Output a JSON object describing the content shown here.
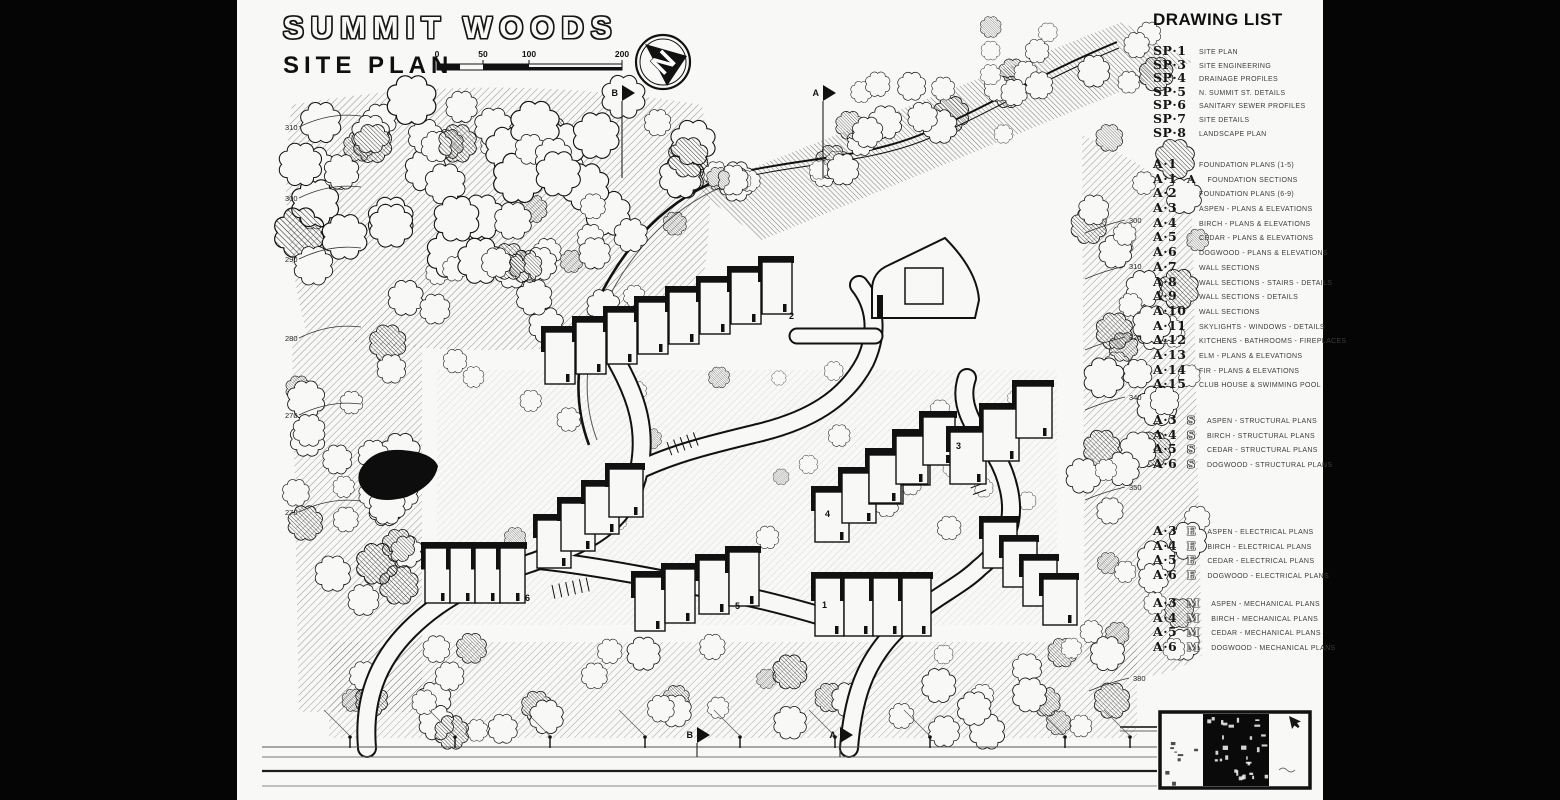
{
  "title": {
    "project": "SUMMIT WOODS",
    "sheet": "SITE PLAN"
  },
  "scale_bar": {
    "labels": [
      "0",
      "50",
      "100",
      "200"
    ]
  },
  "north": {
    "label": "N"
  },
  "section_markers": {
    "top": [
      {
        "label": "B",
        "x": 385,
        "y": 93
      },
      {
        "label": "A",
        "x": 586,
        "y": 93
      }
    ],
    "bottom": [
      {
        "label": "B",
        "x": 460,
        "y": 735
      },
      {
        "label": "A",
        "x": 603,
        "y": 735
      }
    ]
  },
  "drawing_list": {
    "heading": "DRAWING LIST",
    "sp_sheets": [
      {
        "code": "SP·1",
        "suffix": "",
        "title": "SITE PLAN"
      },
      {
        "code": "SP·3",
        "suffix": "",
        "title": "SITE ENGINEERING"
      },
      {
        "code": "SP·4",
        "suffix": "",
        "title": "DRAINAGE PROFILES"
      },
      {
        "code": "SP·5",
        "suffix": "",
        "title": "N. SUMMIT ST. DETAILS"
      },
      {
        "code": "SP·6",
        "suffix": "",
        "title": "SANITARY SEWER PROFILES"
      },
      {
        "code": "SP·7",
        "suffix": "",
        "title": "SITE DETAILS"
      },
      {
        "code": "SP·8",
        "suffix": "",
        "title": "LANDSCAPE PLAN"
      }
    ],
    "a_sheets": [
      {
        "code": "A·1",
        "suffix": "",
        "title": "FOUNDATION PLANS (1-5)"
      },
      {
        "code": "A·1",
        "suffix": "A",
        "title": "FOUNDATION SECTIONS"
      },
      {
        "code": "A·2",
        "suffix": "",
        "title": "FOUNDATION PLANS (6-9)"
      },
      {
        "code": "A·3",
        "suffix": "",
        "title": "ASPEN - PLANS & ELEVATIONS"
      },
      {
        "code": "A·4",
        "suffix": "",
        "title": "BIRCH - PLANS & ELEVATIONS"
      },
      {
        "code": "A·5",
        "suffix": "",
        "title": "CEDAR - PLANS & ELEVATIONS"
      },
      {
        "code": "A·6",
        "suffix": "",
        "title": "DOGWOOD - PLANS & ELEVATIONS"
      },
      {
        "code": "A·7",
        "suffix": "",
        "title": "WALL SECTIONS"
      },
      {
        "code": "A·8",
        "suffix": "",
        "title": "WALL SECTIONS - STAIRS - DETAILS"
      },
      {
        "code": "A·9",
        "suffix": "",
        "title": "WALL SECTIONS - DETAILS"
      },
      {
        "code": "A·10",
        "suffix": "",
        "title": "WALL SECTIONS"
      },
      {
        "code": "A·11",
        "suffix": "",
        "title": "SKYLIGHTS - WINDOWS - DETAILS"
      },
      {
        "code": "A·12",
        "suffix": "",
        "title": "KITCHENS - BATHROOMS - FIREPLACES"
      },
      {
        "code": "A·13",
        "suffix": "",
        "title": "ELM - PLANS & ELEVATIONS"
      },
      {
        "code": "A·14",
        "suffix": "",
        "title": "FIR - PLANS & ELEVATIONS"
      },
      {
        "code": "A·15",
        "suffix": "",
        "title": "CLUB HOUSE & SWIMMING POOL"
      }
    ],
    "structural_sheets": [
      {
        "code": "A·3",
        "suffix": "S",
        "title": "ASPEN - STRUCTURAL PLANS"
      },
      {
        "code": "A·4",
        "suffix": "S",
        "title": "BIRCH - STRUCTURAL PLANS"
      },
      {
        "code": "A·5",
        "suffix": "S",
        "title": "CEDAR - STRUCTURAL PLANS"
      },
      {
        "code": "A·6",
        "suffix": "S",
        "title": "DOGWOOD - STRUCTURAL PLANS"
      }
    ],
    "electrical_sheets": [
      {
        "code": "A·3",
        "suffix": "E",
        "title": "ASPEN - ELECTRICAL PLANS"
      },
      {
        "code": "A·4",
        "suffix": "E",
        "title": "BIRCH - ELECTRICAL PLANS"
      },
      {
        "code": "A·5",
        "suffix": "E",
        "title": "CEDAR - ELECTRICAL PLANS"
      },
      {
        "code": "A·6",
        "suffix": "E",
        "title": "DOGWOOD - ELECTRICAL PLANS"
      }
    ],
    "mechanical_sheets": [
      {
        "code": "A·3",
        "suffix": "M",
        "title": "ASPEN - MECHANICAL PLANS"
      },
      {
        "code": "A·4",
        "suffix": "M",
        "title": "BIRCH - MECHANICAL PLANS"
      },
      {
        "code": "A·5",
        "suffix": "M",
        "title": "CEDAR - MECHANICAL PLANS"
      },
      {
        "code": "A·6",
        "suffix": "M",
        "title": "DOGWOOD - MECHANICAL PLANS"
      }
    ]
  },
  "plan": {
    "contour_labels_left": [
      {
        "value": "310",
        "x": 48,
        "y": 130
      },
      {
        "value": "300",
        "x": 48,
        "y": 201
      },
      {
        "value": "290",
        "x": 48,
        "y": 262
      },
      {
        "value": "280",
        "x": 48,
        "y": 341
      },
      {
        "value": "270",
        "x": 48,
        "y": 418
      },
      {
        "value": "270",
        "x": 48,
        "y": 515
      }
    ],
    "contour_labels_right": [
      {
        "value": "300",
        "x": 892,
        "y": 223
      },
      {
        "value": "310",
        "x": 892,
        "y": 269
      },
      {
        "value": "320",
        "x": 892,
        "y": 340
      },
      {
        "value": "340",
        "x": 892,
        "y": 400
      },
      {
        "value": "350",
        "x": 892,
        "y": 490
      },
      {
        "value": "380",
        "x": 896,
        "y": 681
      }
    ],
    "building_numbers": [
      {
        "label": "1",
        "x": 585,
        "y": 608
      },
      {
        "label": "2",
        "x": 552,
        "y": 319
      },
      {
        "label": "3",
        "x": 719,
        "y": 449
      },
      {
        "label": "4",
        "x": 588,
        "y": 517
      },
      {
        "label": "5",
        "x": 498,
        "y": 609
      },
      {
        "label": "6",
        "x": 288,
        "y": 601
      }
    ]
  },
  "colors": {
    "ink": "#111111",
    "paper": "#f8f8f6",
    "letterbox": "#050505"
  }
}
